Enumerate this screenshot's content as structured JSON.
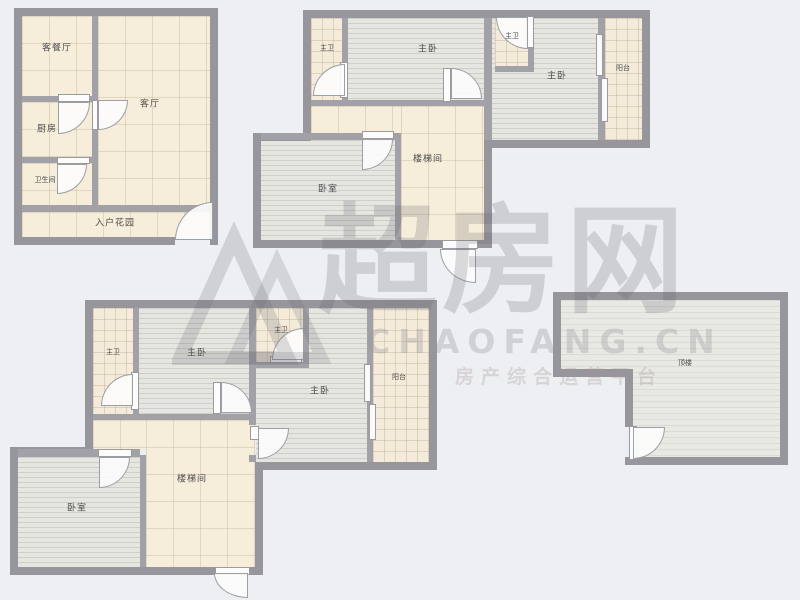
{
  "watermark": {
    "logo": "chaofang-logo",
    "brand": "超房网",
    "domain": "CHAOFANG.CN",
    "tagline": "房产综合运营平台"
  },
  "rooms": {
    "f1": {
      "dining": "客餐厅",
      "living": "客厅",
      "kitchen": "厨房",
      "bathroom": "卫生间",
      "entry_garden": "入户花园"
    },
    "f2": {
      "master_bath_1": "主卫",
      "master_bed_1": "主卧",
      "master_bath_2": "主卫",
      "master_bed_2": "主卧",
      "balcony": "阳台",
      "stairwell": "楼梯间",
      "bedroom": "卧室"
    },
    "f3": {
      "master_bath_1": "主卫",
      "master_bed_1": "主卧",
      "master_bath_2": "主卫",
      "master_bed_2": "主卧",
      "balcony": "阳台",
      "stairwell": "楼梯间",
      "bedroom": "卧室"
    },
    "f4": {
      "roof": "顶楼"
    }
  }
}
